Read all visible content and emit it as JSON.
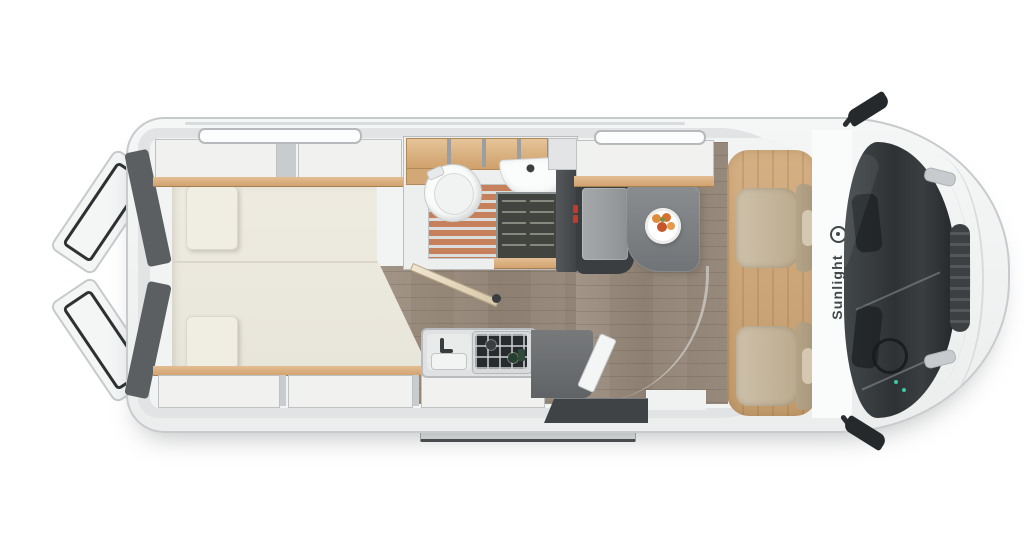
{
  "image": {
    "description": "Top-down 3D floor-plan render of a Sunlight camper van (panel van conversion) with both rear doors open",
    "width": 1024,
    "height": 559
  },
  "brand": {
    "label": "Sunlight",
    "logo_icon": "sun-ring-icon"
  },
  "areas": {
    "rear_bed": {
      "name": "transverse-rear-bed",
      "mattress_sections": 2,
      "back_cushions": 2,
      "overhead_lockers_top": 2,
      "overhead_lockers_bottom": 3
    },
    "bathroom": {
      "fixtures": [
        "cassette-toilet",
        "shower-teak-grate",
        "washbasin",
        "hanging-wardrobe",
        "open-wood-shelves"
      ]
    },
    "kitchen": {
      "fixtures": [
        "sink-with-faucet",
        "two-burner-gas-hob",
        "dark-worktop",
        "tall-cabinet"
      ]
    },
    "dinette": {
      "fixtures": [
        "bench-seat",
        "pedestal-table",
        "plate-of-fruit",
        "overhead-locker"
      ]
    },
    "cab": {
      "fixtures": [
        "swivel-seat-passenger",
        "swivel-seat-driver",
        "oak-floor-panel",
        "windshield-dashboard",
        "side-mirror-left",
        "side-mirror-right",
        "front-grille"
      ]
    },
    "exterior": {
      "fixtures": [
        "rear-door-open-top",
        "rear-door-open-bottom",
        "entry-step-rail",
        "sliding-door-step",
        "skylight-rear",
        "skylight-front",
        "roof-rail"
      ]
    }
  },
  "palette": {
    "background": "#ffffff",
    "body_fill": "#f3f4f4",
    "body_outline": "#c7cbcd",
    "wall_ring": "#e1e3e4",
    "interior": "#f2f3f3",
    "floor_wood": "#95877a",
    "cab_wood": "#c9a478",
    "mattress": "#ebe8dd",
    "cushion": "#f0ede3",
    "cabinet_panel": "#f1f1ef",
    "wood_trim": "#d9ae80",
    "shower_teak": "#c6805c",
    "bathroom_floor": "#edefef",
    "wardrobe": "#41443f",
    "bench_frame": "#3b3e40",
    "bench_cushion": "#9fa2a4",
    "table": "#7d8184",
    "seat_beige": "#c5b8a0",
    "windshield": "#31353七",
    "mirror": "#26292b",
    "step_dark": "#3f4345",
    "accent_red": "#c23a28",
    "fruit_orange": "#e0813a",
    "brand_text": "#43474a"
  }
}
